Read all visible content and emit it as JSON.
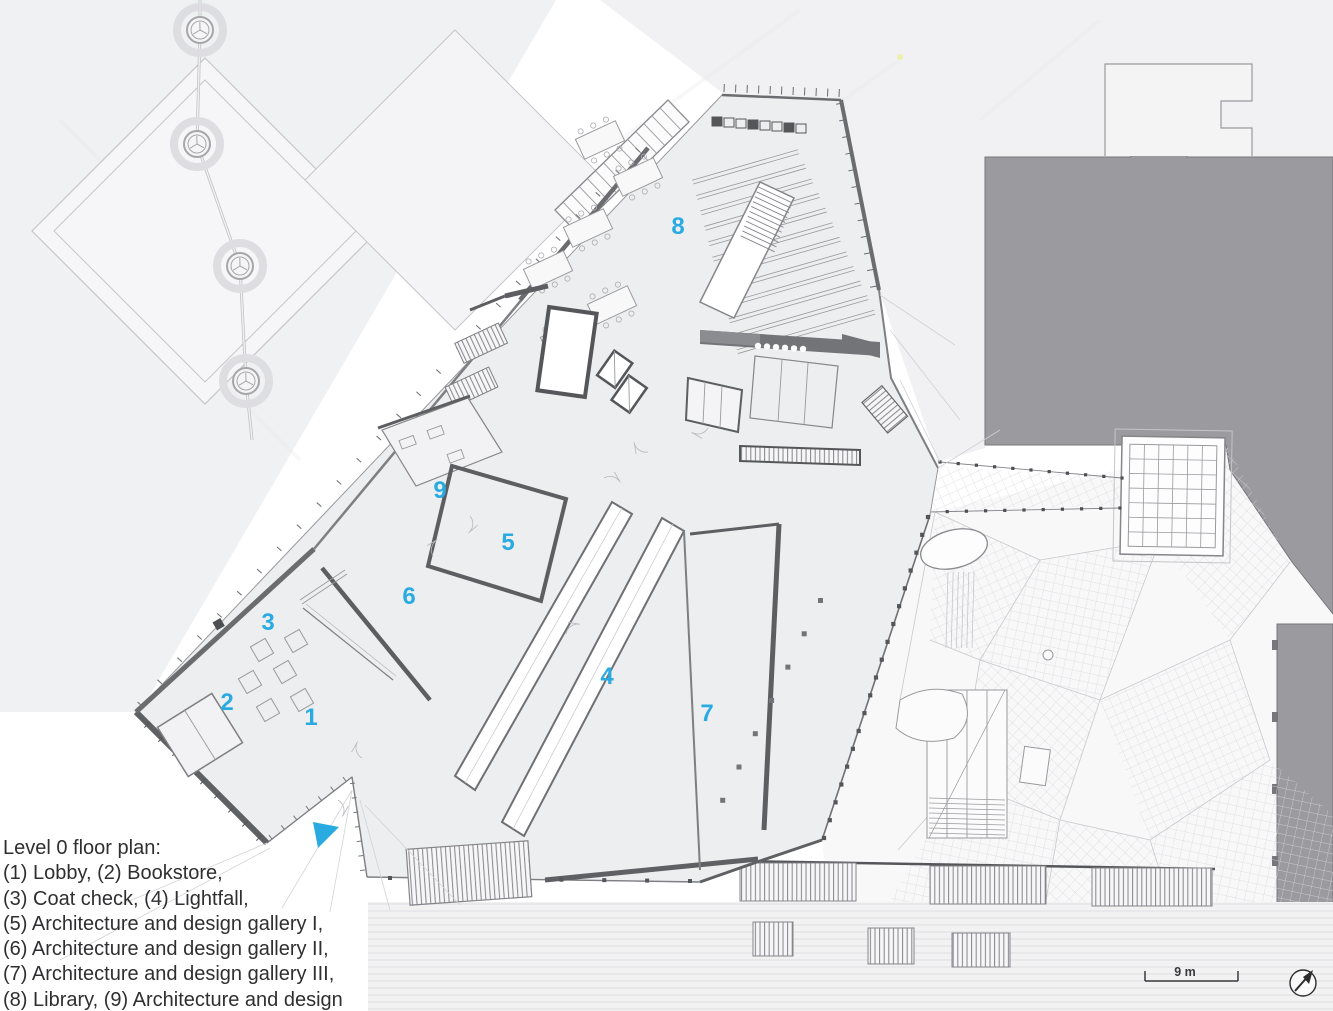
{
  "title": "Level 0 floor plan",
  "legend": {
    "lines": [
      "Level 0 floor plan:",
      "(1) Lobby, (2) Bookstore,",
      "(3) Coat check, (4) Lightfall,",
      "(5) Architecture and design gallery I,",
      "(6) Architecture and design gallery II,",
      "(7) Architecture and design gallery III,",
      "(8) Library, (9) Architecture and design"
    ]
  },
  "plan_labels": [
    {
      "n": "1",
      "room": "Lobby"
    },
    {
      "n": "2",
      "room": "Bookstore"
    },
    {
      "n": "3",
      "room": "Coat check"
    },
    {
      "n": "4",
      "room": "Lightfall"
    },
    {
      "n": "5",
      "room": "Architecture and design gallery I"
    },
    {
      "n": "6",
      "room": "Architecture and design gallery II"
    },
    {
      "n": "7",
      "room": "Architecture and design gallery III"
    },
    {
      "n": "8",
      "room": "Library"
    },
    {
      "n": "9",
      "room": "Architecture and design"
    }
  ],
  "scale_bar": {
    "label": "9 m"
  },
  "colors": {
    "accent_cyan": "#29abe2",
    "building_floor": "#edeef0",
    "wall_dark": "#5d5e62",
    "context_mass_gray": "#9b9b9f",
    "ground_light": "#f1f1f3",
    "legend_text": "#2f2f31"
  }
}
